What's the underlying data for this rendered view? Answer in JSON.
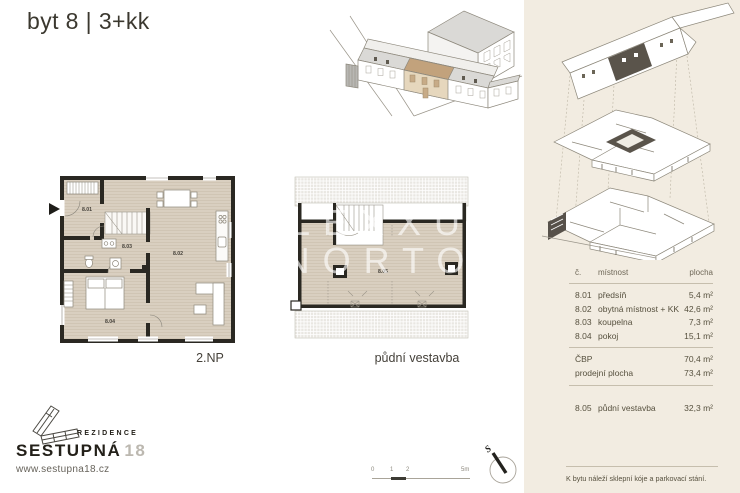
{
  "page": {
    "title": "byt 8 | 3+kk"
  },
  "watermark": {
    "line1": "LEXXUS",
    "line2": "NORTON"
  },
  "plans": {
    "floor2": {
      "label": "2.NP",
      "rooms": {
        "r801": "8.01",
        "r802": "8.02",
        "r803": "8.03",
        "r804": "8.04"
      }
    },
    "attic": {
      "label": "půdní vestavba",
      "rooms": {
        "r805": "8.05"
      }
    }
  },
  "area_table": {
    "headers": {
      "number": "č.",
      "room": "místnost",
      "area": "plocha"
    },
    "rows": [
      {
        "number": "8.01",
        "room": "předsíň",
        "area": "5,4 m²"
      },
      {
        "number": "8.02",
        "room": "obytná místnost + KK",
        "area": "42,6 m²"
      },
      {
        "number": "8.03",
        "room": "koupelna",
        "area": "7,3 m²"
      },
      {
        "number": "8.04",
        "room": "pokoj",
        "area": "15,1 m²"
      }
    ],
    "summary": [
      {
        "label": "ČBP",
        "area": "70,4 m²"
      },
      {
        "label": "prodejní plocha",
        "area": "73,4 m²"
      }
    ],
    "extra": {
      "number": "8.05",
      "room": "půdní vestavba",
      "area": "32,3 m²"
    },
    "note": "K bytu náleží sklepní kóje a parkovací stání."
  },
  "logo": {
    "tagline": "REZIDENCE",
    "name": "SESTUPNÁ",
    "number": "18",
    "website": "www.sestupna18.cz"
  },
  "scale_bar": {
    "t0": "0",
    "t1": "1",
    "t2": "2",
    "t5": "5m"
  },
  "compass": {
    "north": "S"
  },
  "colors": {
    "panel_bg": "#f2ece1",
    "floor": "#d9cfc0",
    "wall": "#2a2822",
    "highlight_tan": "#c2a27c",
    "dark_highlight": "#5a544b",
    "ink": "#56503e"
  }
}
